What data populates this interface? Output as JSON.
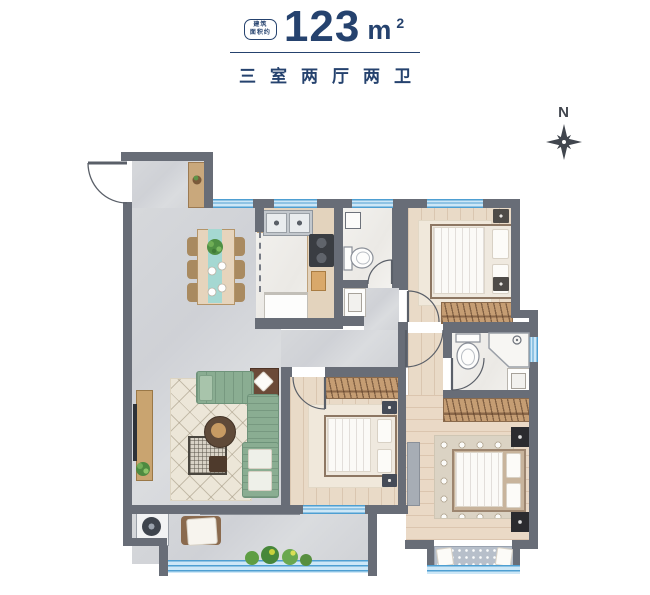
{
  "header": {
    "badge": {
      "line1": "建筑",
      "line2": "面积约"
    },
    "area": {
      "value": "123",
      "unit": "m",
      "exponent": "2"
    },
    "subtitle": "三室两厅两卫"
  },
  "compass": {
    "label": "N"
  },
  "palette": {
    "accent_navy": "#25426e",
    "wall": "#686d77",
    "window_blue": "#4e9fd2",
    "window_fill": "#cde7f7",
    "sofa_green": "#8aad92",
    "runner_teal": "#a5d8d2",
    "furniture_wood": "#c59d73",
    "furniture_dark": "#2e3136",
    "floor_gray": "#d3d5d9",
    "floor_wood": "#e9dac7",
    "floor_white": "#f3f2ef"
  }
}
